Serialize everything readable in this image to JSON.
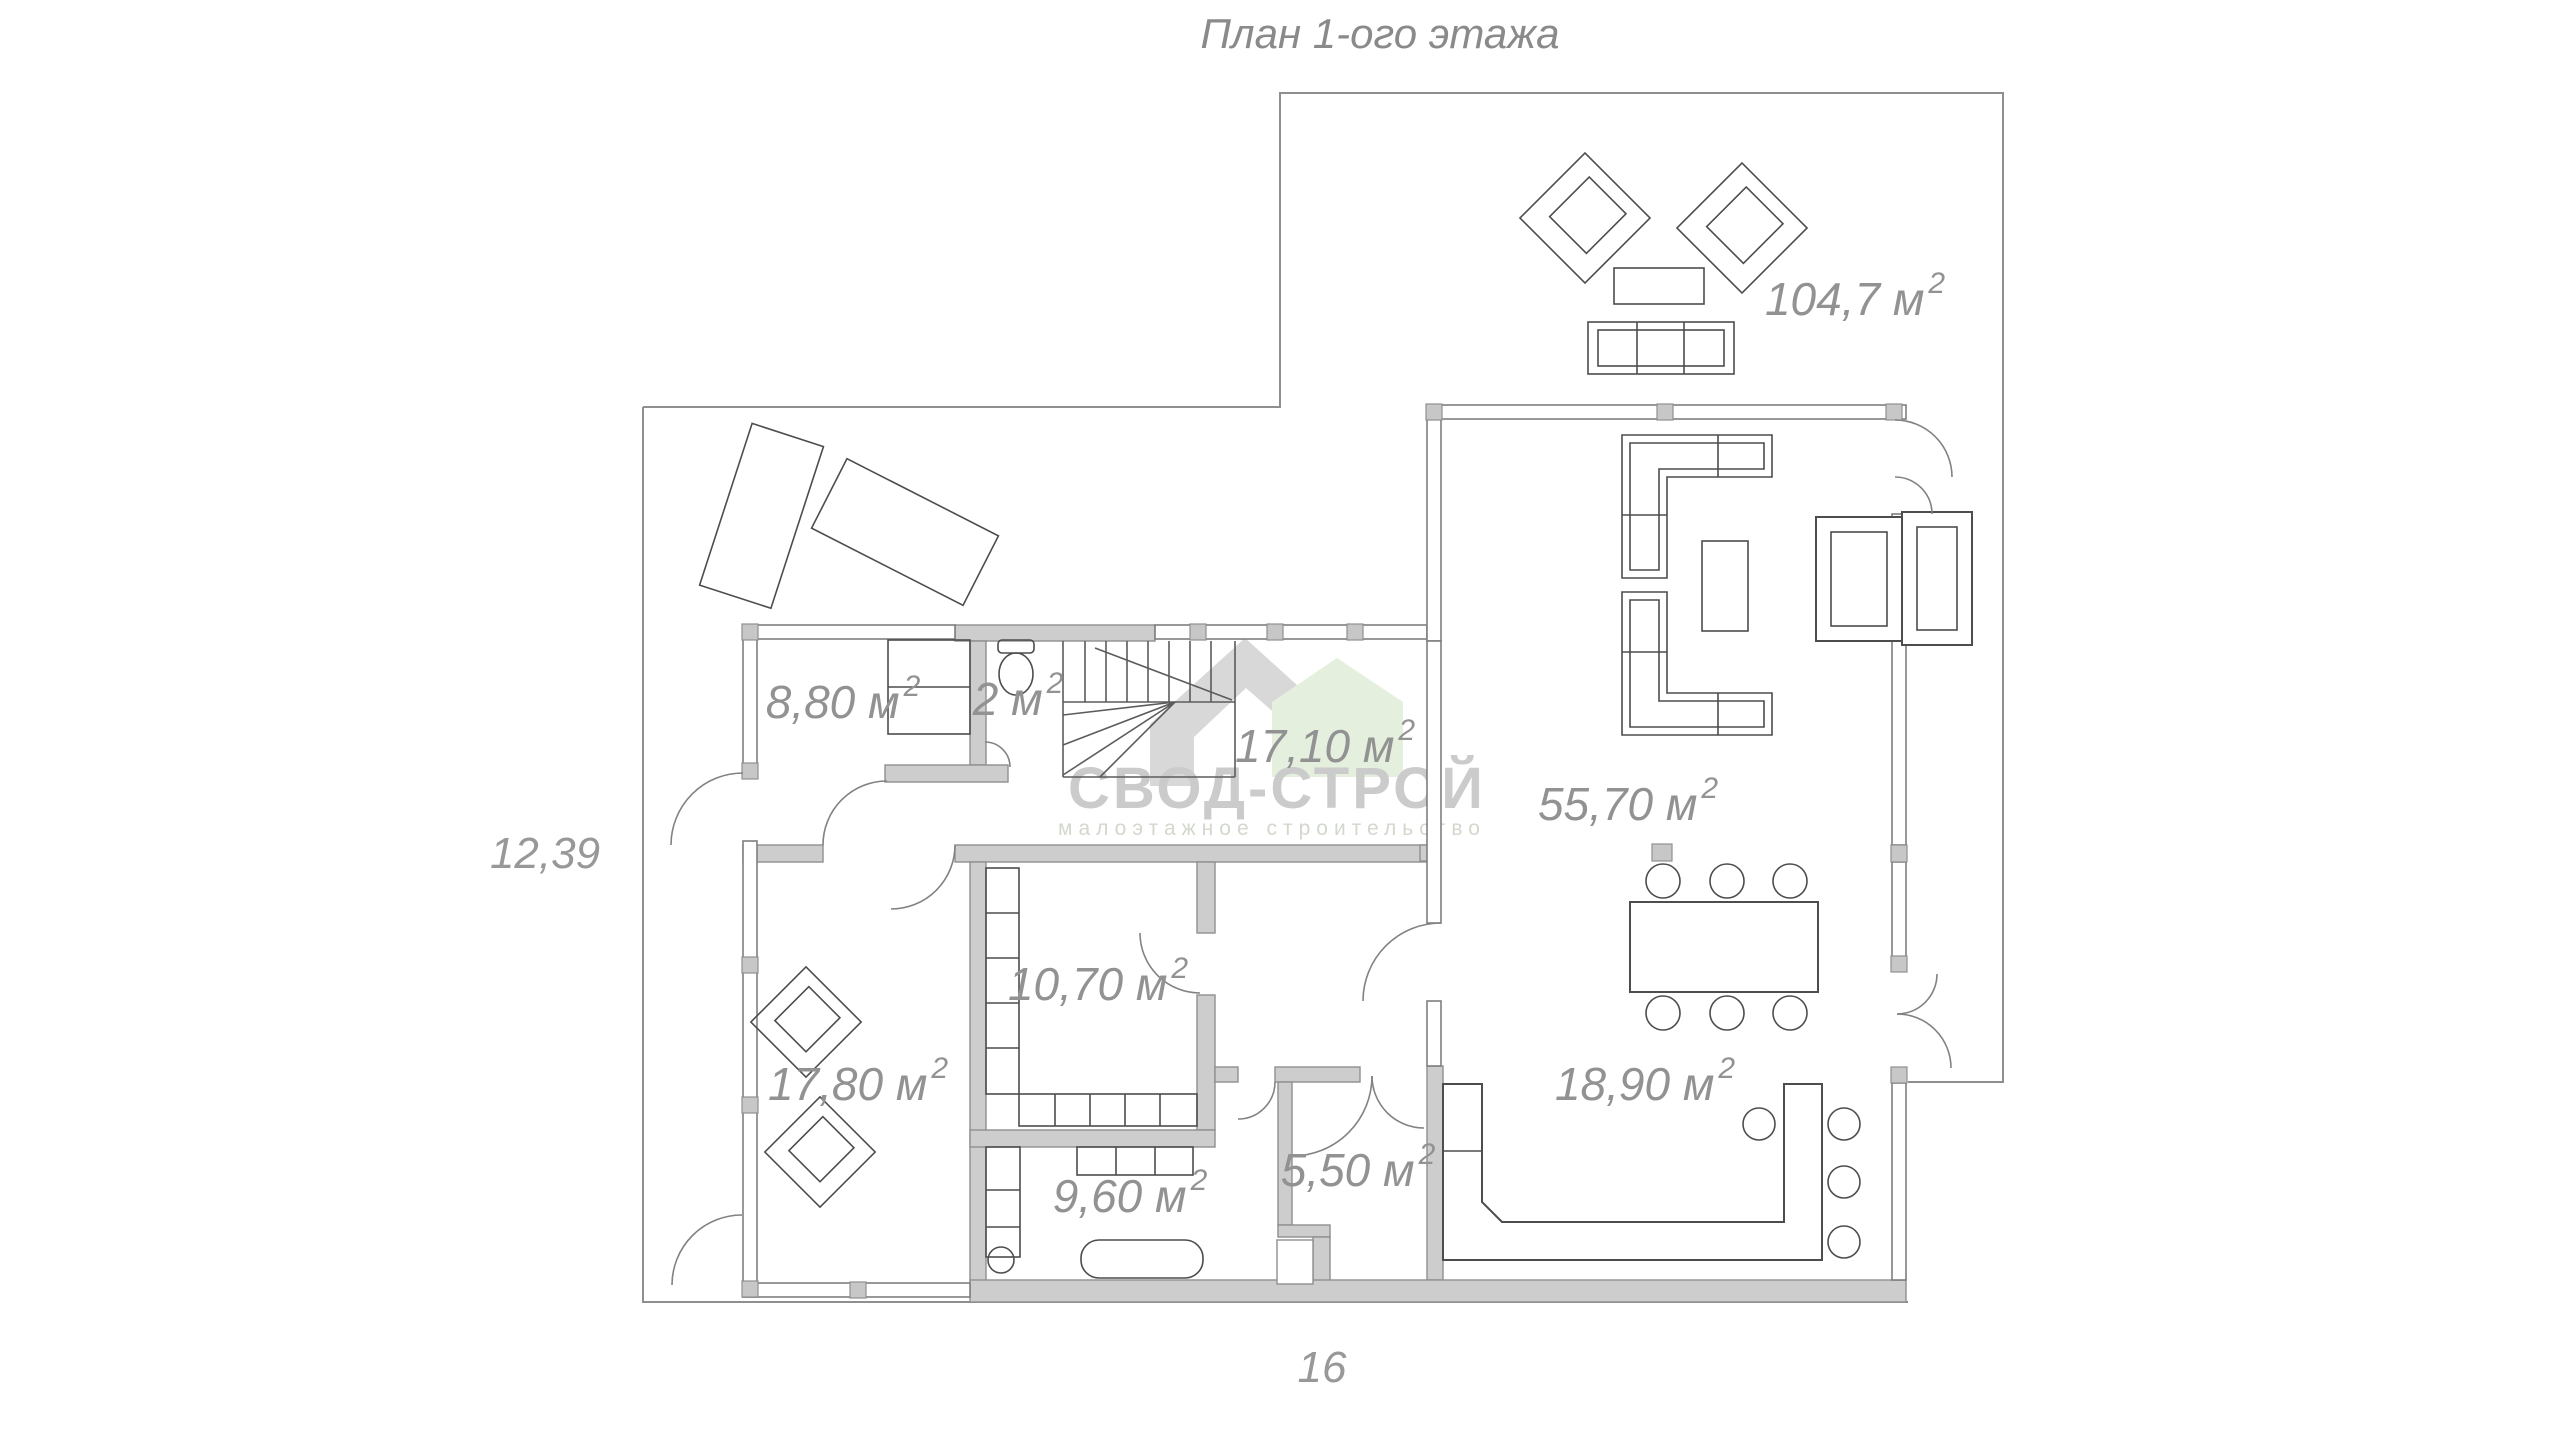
{
  "title": "План 1-ого этажа",
  "watermark": {
    "name": "СВОД-СТРОЙ",
    "tagline": "малоэтажное строительство",
    "logo": "house-logo-icon",
    "colors": {
      "ribbon": "#d8d8d8",
      "house": "#e4efdd",
      "name_text": "#cbcbcb",
      "tagline_text": "#d3d8cd"
    }
  },
  "dimensions": {
    "left": "12,39",
    "bottom": "16"
  },
  "rooms": [
    {
      "id": "terrace",
      "label": "104,7 м",
      "sup": "2"
    },
    {
      "id": "bedroom",
      "label": "8,80 м",
      "sup": "2"
    },
    {
      "id": "wc",
      "label": "2 м",
      "sup": "2"
    },
    {
      "id": "hall",
      "label": "17,10 м",
      "sup": "2"
    },
    {
      "id": "living",
      "label": "55,70 м",
      "sup": "2"
    },
    {
      "id": "dressing",
      "label": "10,70 м",
      "sup": "2"
    },
    {
      "id": "cabinet",
      "label": "17,80 м",
      "sup": "2"
    },
    {
      "id": "kitchen",
      "label": "18,90 м",
      "sup": "2"
    },
    {
      "id": "bathroom",
      "label": "9,60 м",
      "sup": "2"
    },
    {
      "id": "entry",
      "label": "5,50 м",
      "sup": "2"
    }
  ],
  "colors": {
    "wall_fill": "#cdcdcd",
    "wall_stroke": "#8f8f8f",
    "label_gray": "#929292",
    "line_gray": "#4d4d4d",
    "background": "#ffffff"
  }
}
